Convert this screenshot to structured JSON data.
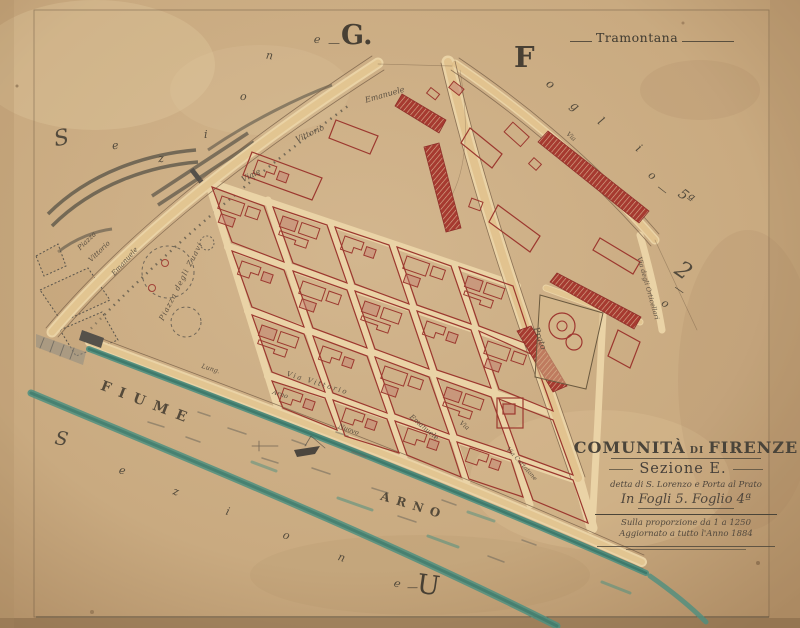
{
  "sheet": {
    "compass_label": "Tramontana",
    "margin_top": {
      "letters": [
        "S",
        "e",
        "z",
        "i",
        "o",
        "n",
        "e",
        "—"
      ],
      "big": "G."
    },
    "margin_right": {
      "letters": [
        "F",
        "o",
        "g",
        "l",
        "i",
        "o",
        "—",
        "5ª"
      ],
      "extra": [
        "2",
        "—",
        "o"
      ]
    },
    "margin_bottom": {
      "letters": [
        "S",
        "e",
        "z",
        "i",
        "o",
        "n",
        "e",
        "—"
      ],
      "big": "U"
    }
  },
  "river": {
    "word1": "FIUME",
    "word2": "ARNO"
  },
  "map_labels": {
    "piazza_line1": "Piazza",
    "piazza_line2": "Vittorio",
    "piazza_line3": "Emanuele",
    "piazza_zuavi": "Piazza degli Zuavi",
    "viale_word1": "Viale",
    "viale_word2": "Vittorio",
    "viale_word3": "Emanuele",
    "via_vittorio": "Via Vittorio",
    "lungarno_word1": "Lung.",
    "lungarno_word2": "Arno",
    "lungarno_word3": "Nuovo",
    "via_emanuele": "Emanuele",
    "via_short": "Via",
    "via_top": "Via",
    "prato": "Prato",
    "via_curtatone": "Via Curtatone",
    "via_orticellari": "Via degli Orticellari"
  },
  "title_block": {
    "community_word1": "COMUNITÀ",
    "community_word2": "DI",
    "community_word3": "FIRENZE",
    "section_line": "Sezione E.",
    "subtitle": "detta di S. Lorenzo e Porta al Prato",
    "sheet_line": "In Fogli 5. Foglio 4ª",
    "scale_line": "Sulla proporzione da 1 a 1250",
    "updated_line": "Aggiornato a tutto l'Anno 1884"
  },
  "colors": {
    "paper": "#c9aa80",
    "river_teal": "#4e8f80",
    "building_red": "#9c382f",
    "street_cream": "#ead3a6",
    "ink": "#4a4136"
  }
}
